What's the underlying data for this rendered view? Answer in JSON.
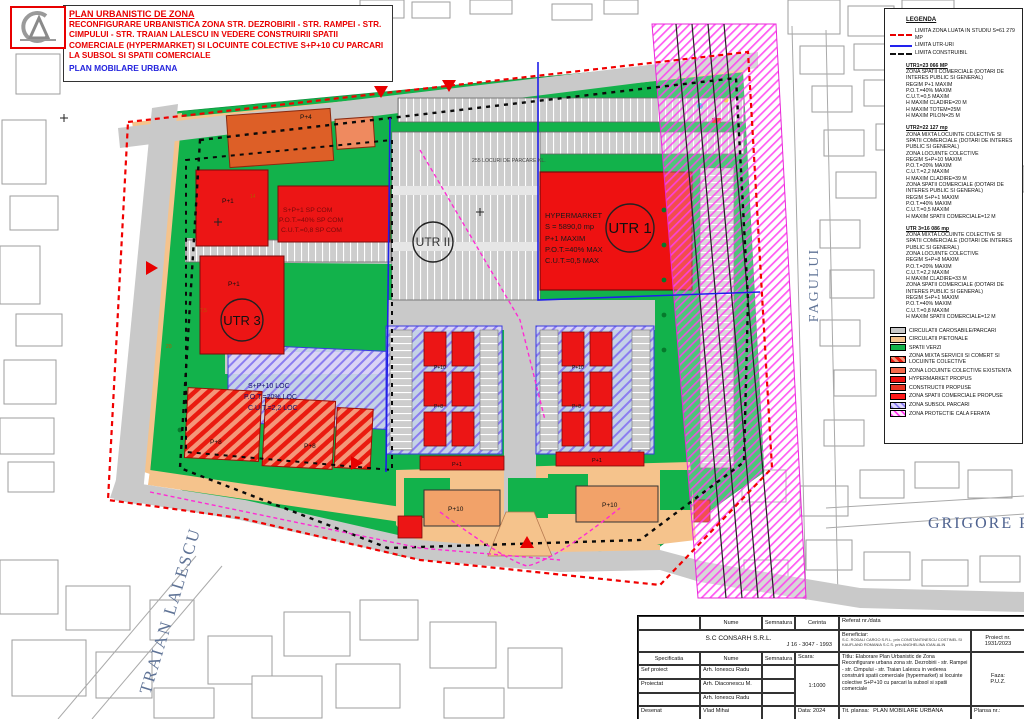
{
  "title_box": {
    "line1": "PLAN URBANISTIC DE ZONA",
    "line2": "RECONFIGURARE URBANISTICA ZONA STR. DEZROBIRII - STR. RAMPEI - STR. CIMPULUI - STR. TRAIAN LALESCU IN VEDERE CONSTRUIRII SPATII COMERCIALE (HYPERMARKET) SI LOCUINTE COLECTIVE S+P+10 CU PARCARI LA SUBSOL SI SPATII COMERCIALE",
    "line3": "PLAN MOBILARE URBANA"
  },
  "legend": {
    "title": "LEGENDA",
    "line_items": [
      {
        "label": "LIMITA ZONA LUATA IN STUDIU S=61 279 MP"
      },
      {
        "label": "LIMITA UTR-URI"
      },
      {
        "label": "LIMITA CONSTRUIBIL"
      }
    ],
    "utr1": {
      "heading": "UTR1=23 066 MP",
      "lines": [
        "ZONA SPATII COMERCIALE (DOTARI DE INTERES PUBLIC SI GENERAL)",
        "REGIM P+1 MAXIM",
        "P.O.T.=40% MAXIM",
        "C.U.T.=0,5 MAXIM",
        "H MAXIM CLADIRE=20 M",
        "H MAXIM TOTEM=25M",
        "H MAXIM PILON=25 M"
      ]
    },
    "utr2": {
      "heading": "UTR2=22 127 mp",
      "lines": [
        "ZONA MIXTA LOCUINTE COLECTIVE SI SPATII COMERCIALE (DOTARI DE INTERES PUBLIC SI GENERAL)",
        "ZONA LOCUINTE COLECTIVE",
        "REGIM S+P+10 MAXIM",
        "P.O.T.=20% MAXIM",
        "C.U.T.=2,2 MAXIM",
        "H MAXIM CLADIRE=39 M",
        "ZONA SPATII COMERCIALE (DOTARI DE INTERES PUBLIC SI GENERAL)",
        "REGIM S+P+1 MAXIM",
        "P.O.T.=40% MAXIM",
        "C.U.T.=0,5 MAXIM",
        "H MAXIM SPATII COMERCIALE=12 M"
      ]
    },
    "utr3": {
      "heading": "UTR 3=16 086 mp",
      "lines": [
        "ZONA MIXTA LOCUINTE COLECTIVE SI SPATII COMERCIALE (DOTARI DE INTERES PUBLIC SI GENERAL)",
        "ZONA LOCUINTE COLECTIVE",
        "REGIM S+P+8 MAXIM",
        "P.O.T.=20% MAXIM",
        "C.U.T.=2,2 MAXIM",
        "H MAXIM CLADIRE=33 M",
        "ZONA SPATII COMERCIALE (DOTARI DE INTERES PUBLIC SI GENERAL)",
        "REGIM S+P+1 MAXIM",
        "P.O.T.=40% MAXIM",
        "C.U.T.=0,8 MAXIM",
        "H MAXIM SPATII COMERCIALE=12 M"
      ]
    },
    "color_items": [
      {
        "label": "CIRCULATII CAROSABILE/PARCARI",
        "color": "#c9c9c9"
      },
      {
        "label": "CIRCULATII PIETONALE",
        "color": "#f5c38c"
      },
      {
        "label": "SPATII VERZI",
        "color": "#12b24b"
      },
      {
        "label": "ZONA MIXTA SERVICII SI COMERT SI LOCUINTE COLECTIVE",
        "color": "#ea1b10"
      },
      {
        "label": "ZONA LOCUINTE COLECTIVE EXISTENTA",
        "color": "#f4694b"
      },
      {
        "label": "HYPERMARKET PROPUS",
        "color": "#ee1111"
      },
      {
        "label": "CONSTRUCTII PROPUSE",
        "color": "#e93323"
      },
      {
        "label": "ZONA SPATII COMERCIALE PROPUSE",
        "color": "#ff1a1a"
      },
      {
        "label": "ZONA SUBSOL PARCARI",
        "color": "#c8c0ff"
      },
      {
        "label": "ZONA PROTECTIE CALA FERATA",
        "color": "#ff3df0"
      }
    ]
  },
  "map": {
    "badges": {
      "utr1": "UTR 1",
      "utr2": "UTR II",
      "utr3": "UTR 3"
    },
    "hypermarket_lines": [
      "HYPERMARKET",
      "S = 5890,0 mp",
      "P+1 MAXIM",
      "P.O.T.=40% MAX",
      "C.U.T.=0,5 MAX"
    ],
    "sp_com_lines": [
      "S+P+1 SP COM",
      "P.O.T.=40% SP COM",
      "C.U.T.=0,8 SP COM"
    ],
    "loc_lines": [
      "S+P+10 LOC",
      "P.O.T.=20% LOC",
      "C.U.T.=2,2 LOC"
    ],
    "parking_count_label": "255 LOCURI DE PARCARE KL.",
    "labels": {
      "p4": "P+4",
      "p1a": "P+1",
      "p1b": "P+1",
      "p8a": "P+8",
      "p8b": "P+8",
      "p10a": "P+10",
      "p10b": "P+10",
      "p1c": "P+1",
      "p1d": "P+1",
      "t1": "P+10",
      "t2": "P+8",
      "t3": "P+10",
      "t4": "P+8"
    },
    "streets": {
      "traian_lalescu": "TRAIAN LALESCU",
      "fagului": "FAGULUI",
      "grigore": "GRIGORE P"
    },
    "dims": [
      "7,5",
      "20",
      "14"
    ]
  },
  "title_block": {
    "nume_header": "Nume",
    "semnatura_header": "Semnatura",
    "cerinta_header": "Cerinta",
    "referat_header": "Referat nr./data",
    "company": "S.C CONSARH S.R.L.",
    "company_reg": "J 16 - 3047 - 1993",
    "specificatia_header": "Specificatia",
    "rows": [
      {
        "role": "Sef proiect",
        "name": "Arh. Ionescu Radu"
      },
      {
        "role": "Proiectat",
        "name": "Arh. Diaconescu M."
      },
      {
        "role": "",
        "name": "Arh. Ionescu Radu"
      },
      {
        "role": "Desenat",
        "name": "Vlad Mihai"
      }
    ],
    "scara_label": "Scara:",
    "scara_value": "1:1000",
    "data_label": "Data: 2024",
    "beneficiar_label": "Beneficiar:",
    "beneficiar_value": "S.C. RODALI CARGO S.R.L. prin CONSTANTINESCU COSTINEL SI KAUFLAND ROMANIA S.C.S. prin ANGHELINA IOAN-ALIN",
    "proiect_label": "Proiect nr.",
    "proiect_value": "1931/2023",
    "titlu_label": "Titlu:",
    "titlu_value": "Elaborare Plan Urbanistic de Zona Reconfigurare urbana zona str. Dezrobirii - str. Rampei - str. Cimpului - str. Traian Lalescu in vederea construirii spatii comerciale (hypermarket) si locuinte colective S+P+10 cu parcari la subsol si spatii comerciale",
    "faza_label": "Faza:",
    "faza_value": "P.U.Z.",
    "plansa_title_label": "Tit. plansa:",
    "plansa_title_value": "PLAN MOBILARE URBANA",
    "plansa_nr_label": "Plansa nr.:"
  }
}
